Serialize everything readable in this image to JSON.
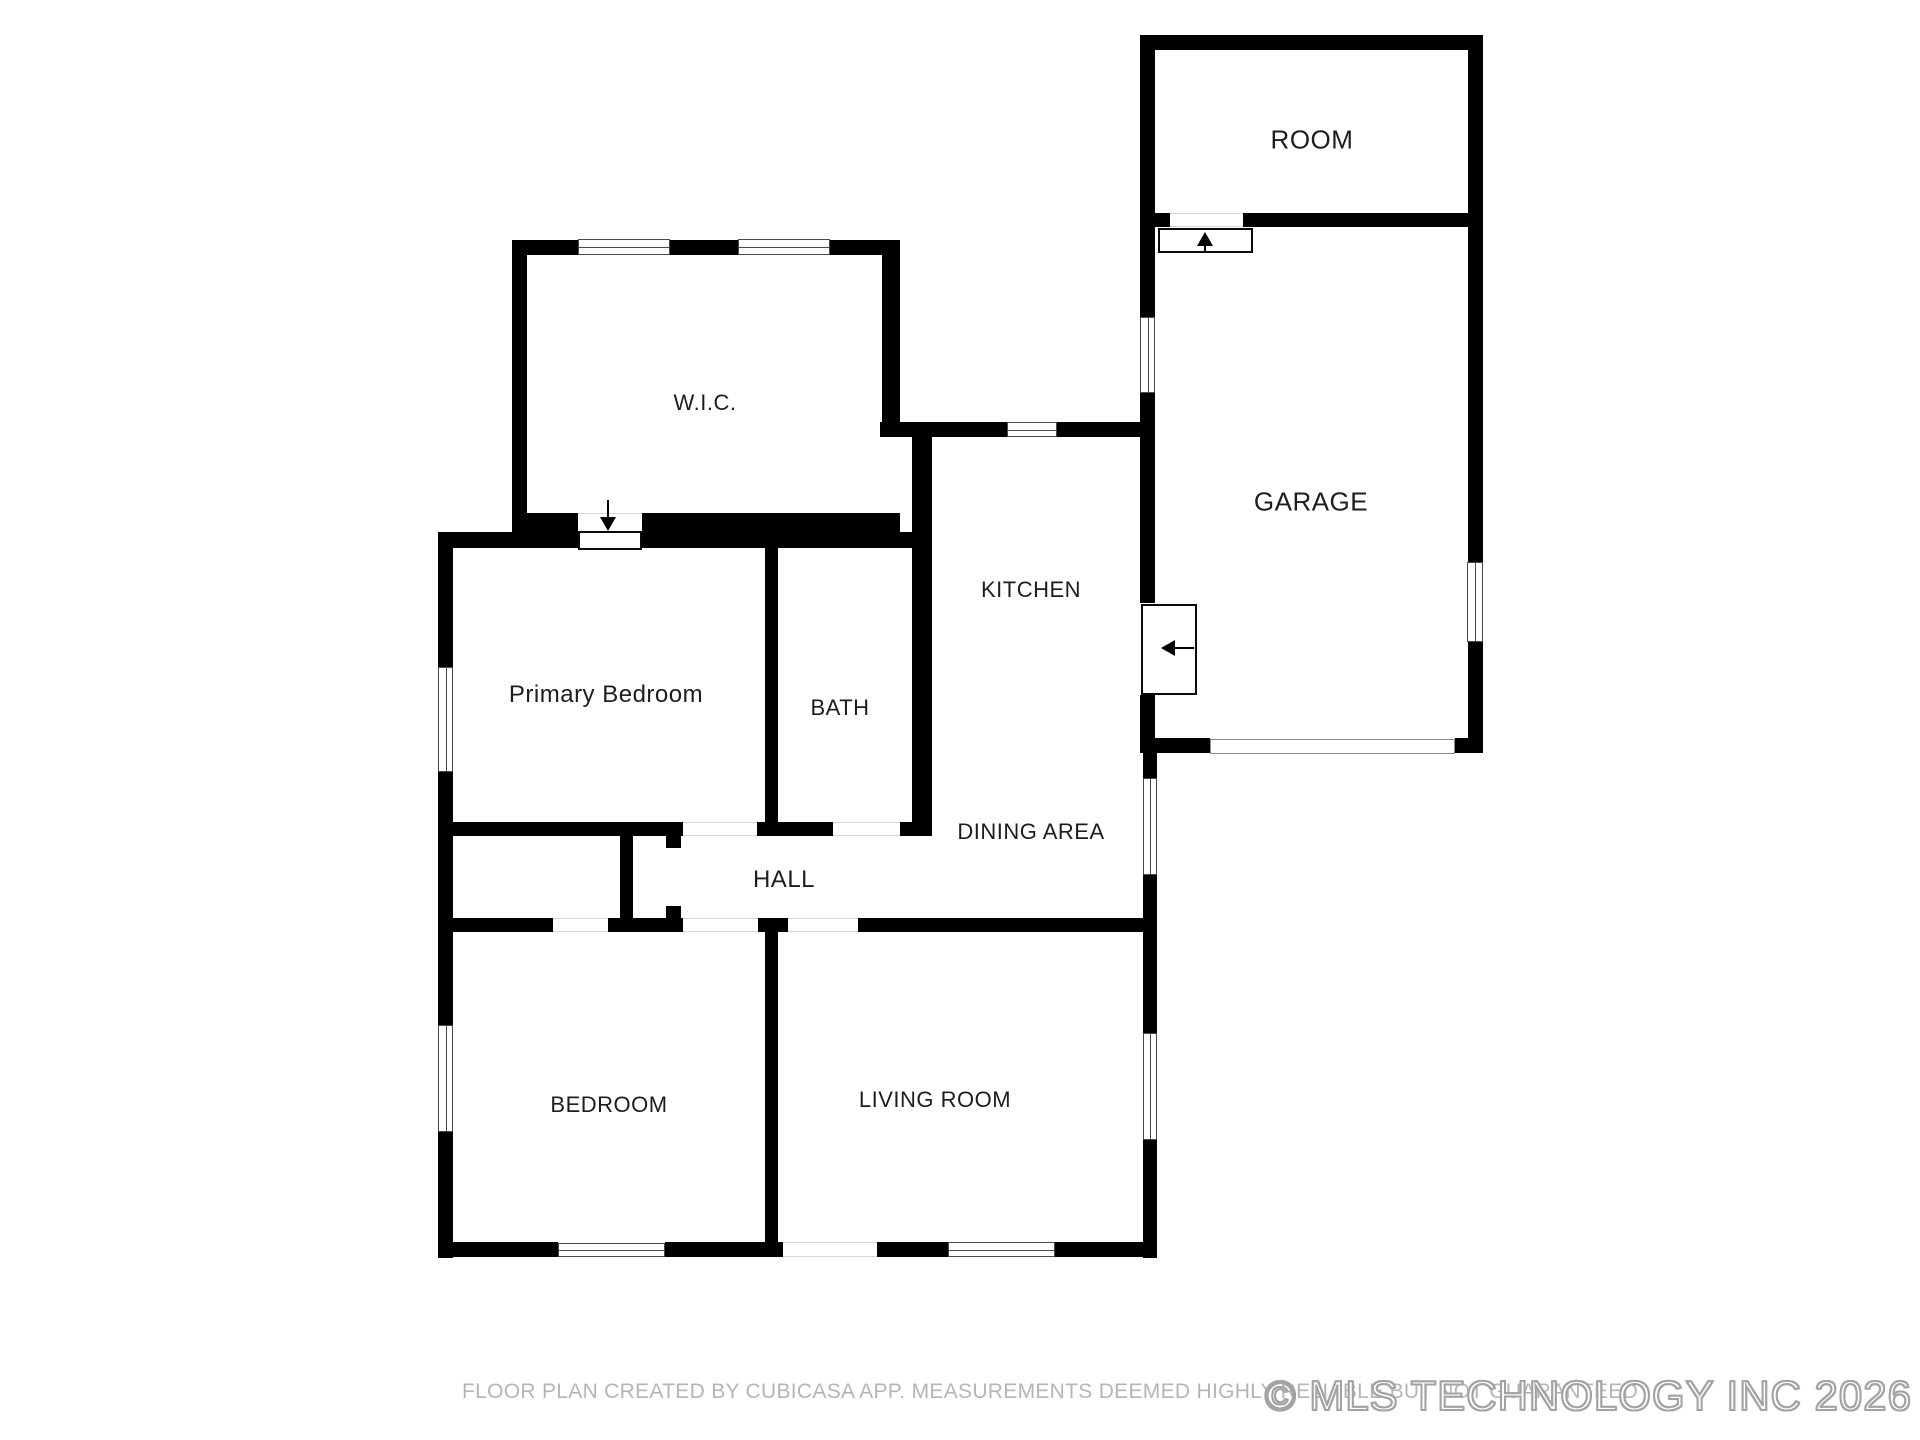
{
  "footer": {
    "disclaimer": "FLOOR PLAN CREATED BY CUBICASA APP. MEASUREMENTS DEEMED HIGHLY RELIABLE BUT NOT GUARANTEED",
    "watermark": "© MLS TECHNOLOGY INC 2026"
  },
  "colors": {
    "wall": "#000000",
    "label_text": "#1d1d1d",
    "disclaimer_text": "#b5b5b5",
    "watermark_outline": "#a3a3a3",
    "background": "#ffffff"
  },
  "plan": {
    "labels": [
      {
        "id": "room",
        "text": "ROOM",
        "x": 1312,
        "y": 140,
        "size": 26
      },
      {
        "id": "garage",
        "text": "GARAGE",
        "x": 1311,
        "y": 502,
        "size": 26
      },
      {
        "id": "wic",
        "text": "W.I.C.",
        "x": 705,
        "y": 403,
        "size": 22
      },
      {
        "id": "kitchen",
        "text": "KITCHEN",
        "x": 1031,
        "y": 590,
        "size": 22
      },
      {
        "id": "primary-bedroom",
        "text": "Primary Bedroom",
        "x": 606,
        "y": 695,
        "size": 24
      },
      {
        "id": "bath",
        "text": "BATH",
        "x": 840,
        "y": 708,
        "size": 22
      },
      {
        "id": "dining-area",
        "text": "DINING AREA",
        "x": 1031,
        "y": 832,
        "size": 22
      },
      {
        "id": "hall",
        "text": "HALL",
        "x": 784,
        "y": 880,
        "size": 24
      },
      {
        "id": "bedroom",
        "text": "BEDROOM",
        "x": 609,
        "y": 1105,
        "size": 22
      },
      {
        "id": "living-room",
        "text": "LIVING ROOM",
        "x": 935,
        "y": 1100,
        "size": 22
      }
    ],
    "walls": [
      [
        438,
        532,
        15,
        135
      ],
      [
        438,
        772,
        15,
        253
      ],
      [
        438,
        1132,
        15,
        126
      ],
      [
        438,
        1242,
        120,
        15
      ],
      [
        665,
        1242,
        118,
        15
      ],
      [
        877,
        1242,
        71,
        15
      ],
      [
        1055,
        1242,
        102,
        15
      ],
      [
        1143,
        753,
        14,
        25
      ],
      [
        1143,
        875,
        14,
        158
      ],
      [
        1143,
        1140,
        14,
        118
      ],
      [
        512,
        240,
        15,
        292
      ],
      [
        512,
        240,
        66,
        15
      ],
      [
        670,
        240,
        68,
        15
      ],
      [
        830,
        240,
        70,
        15
      ],
      [
        882,
        240,
        18,
        197
      ],
      [
        512,
        513,
        66,
        35
      ],
      [
        642,
        513,
        258,
        20
      ],
      [
        642,
        532,
        290,
        16
      ],
      [
        438,
        532,
        140,
        16
      ],
      [
        880,
        422,
        127,
        15
      ],
      [
        1057,
        422,
        86,
        15
      ],
      [
        912,
        437,
        20,
        396
      ],
      [
        765,
        547,
        13,
        275
      ],
      [
        438,
        822,
        245,
        14
      ],
      [
        757,
        822,
        76,
        14
      ],
      [
        900,
        822,
        32,
        14
      ],
      [
        620,
        822,
        13,
        110
      ],
      [
        666,
        832,
        15,
        16
      ],
      [
        666,
        906,
        15,
        16
      ],
      [
        438,
        918,
        115,
        14
      ],
      [
        608,
        918,
        75,
        14
      ],
      [
        758,
        918,
        30,
        14
      ],
      [
        858,
        918,
        299,
        14
      ],
      [
        765,
        920,
        13,
        322
      ],
      [
        1140,
        35,
        343,
        15
      ],
      [
        1140,
        35,
        15,
        192
      ],
      [
        1468,
        50,
        15,
        512
      ],
      [
        1468,
        642,
        15,
        111
      ],
      [
        1155,
        213,
        15,
        14
      ],
      [
        1243,
        213,
        225,
        14
      ],
      [
        1140,
        227,
        15,
        90
      ],
      [
        1140,
        393,
        15,
        210
      ],
      [
        1140,
        695,
        15,
        58
      ],
      [
        1155,
        738,
        55,
        15
      ],
      [
        1455,
        738,
        28,
        15
      ]
    ],
    "openings": [
      {
        "rect": [
          683,
          822,
          74,
          14
        ],
        "orient": "h",
        "name": "primary-bedroom-door-opening"
      },
      {
        "rect": [
          833,
          822,
          67,
          14
        ],
        "orient": "h",
        "name": "bath-door-opening"
      },
      {
        "rect": [
          553,
          918,
          55,
          14
        ],
        "orient": "h",
        "name": "closet-door-opening"
      },
      {
        "rect": [
          683,
          918,
          75,
          14
        ],
        "orient": "h",
        "name": "bedroom-door-opening"
      },
      {
        "rect": [
          788,
          918,
          70,
          14
        ],
        "orient": "h",
        "name": "living-room-door-opening"
      },
      {
        "rect": [
          783,
          1242,
          94,
          15
        ],
        "orient": "h",
        "name": "front-entry-opening"
      },
      {
        "rect": [
          1170,
          213,
          73,
          14
        ],
        "orient": "h",
        "name": "room-door-opening"
      },
      {
        "rect": [
          578,
          513,
          64,
          35
        ],
        "orient": "h",
        "name": "wic-door-opening"
      }
    ],
    "windows": [
      {
        "rect": [
          578,
          239,
          92,
          16
        ],
        "orient": "h"
      },
      {
        "rect": [
          738,
          239,
          92,
          16
        ],
        "orient": "h"
      },
      {
        "rect": [
          1007,
          422,
          50,
          15
        ],
        "orient": "h"
      },
      {
        "rect": [
          438,
          667,
          15,
          105
        ],
        "orient": "v"
      },
      {
        "rect": [
          438,
          1025,
          15,
          107
        ],
        "orient": "v"
      },
      {
        "rect": [
          558,
          1243,
          107,
          14
        ],
        "orient": "h"
      },
      {
        "rect": [
          948,
          1242,
          107,
          15
        ],
        "orient": "h"
      },
      {
        "rect": [
          1143,
          778,
          14,
          97
        ],
        "orient": "v"
      },
      {
        "rect": [
          1143,
          1033,
          14,
          107
        ],
        "orient": "v"
      },
      {
        "rect": [
          1467,
          562,
          16,
          80
        ],
        "orient": "v"
      },
      {
        "rect": [
          1140,
          317,
          15,
          76
        ],
        "orient": "v"
      }
    ],
    "garage_door": {
      "rect": [
        1210,
        739,
        245,
        15
      ]
    },
    "door_boxes": [
      {
        "rect": [
          578,
          531,
          64,
          19
        ],
        "name": "wic-door-swing-box"
      },
      {
        "rect": [
          1158,
          228,
          95,
          25
        ],
        "name": "room-door-swing-box"
      },
      {
        "rect": [
          1141,
          604,
          56,
          91
        ],
        "name": "garage-door-swing-box"
      }
    ],
    "arrows": [
      {
        "dir": "down",
        "x": 608,
        "y": 500,
        "len": 31,
        "name": "wic-entry-arrow"
      },
      {
        "dir": "up",
        "x": 1205,
        "y": 229,
        "len": 23,
        "name": "room-entry-arrow"
      },
      {
        "dir": "left",
        "x": 1158,
        "y": 648,
        "len": 36,
        "name": "garage-entry-arrow"
      }
    ]
  }
}
